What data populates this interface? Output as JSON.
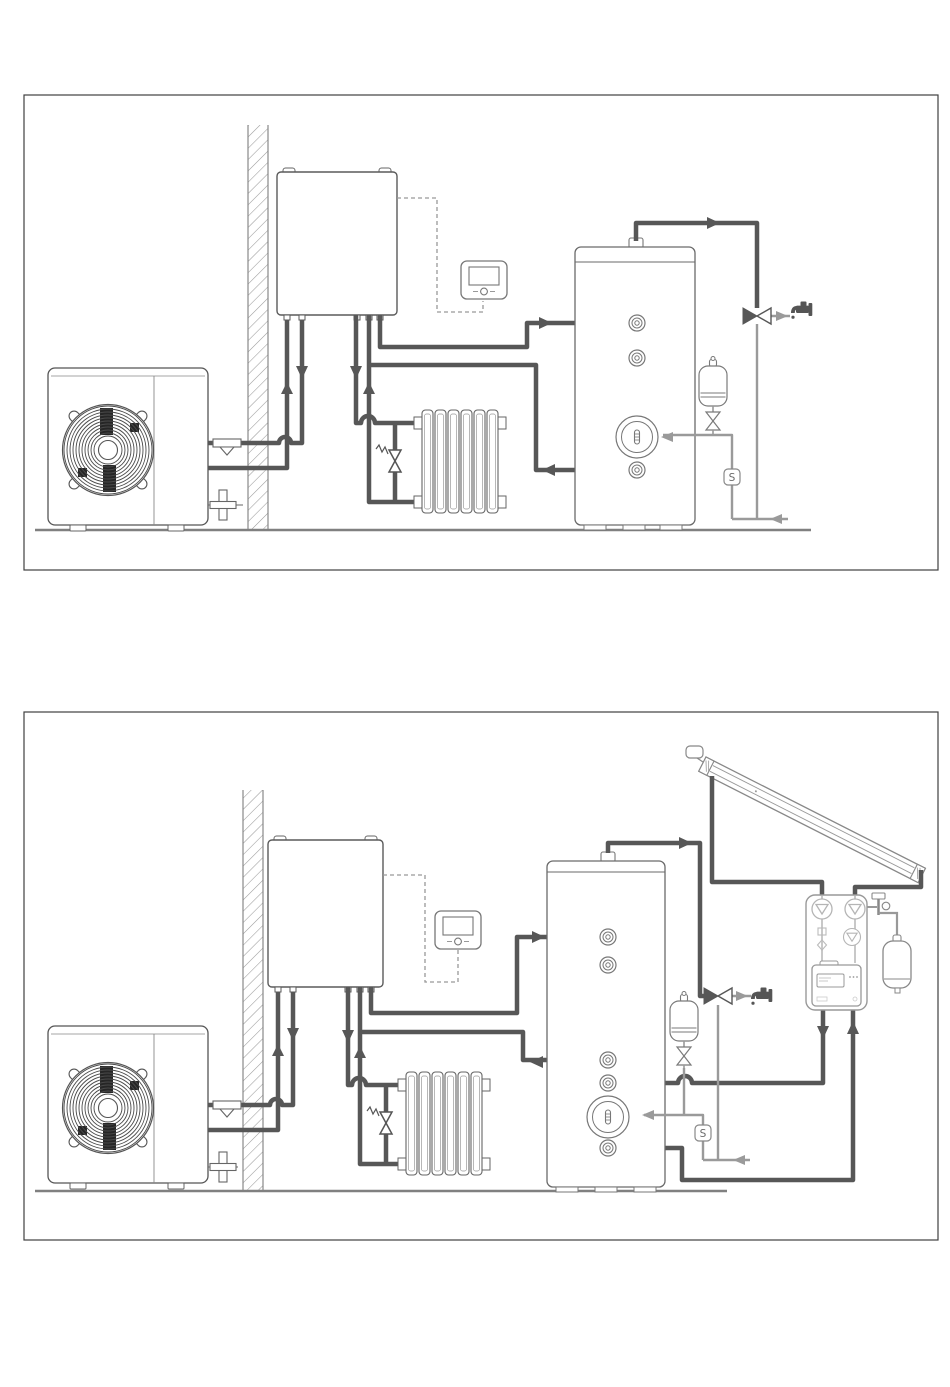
{
  "page": {
    "background": "#ffffff",
    "width": 950,
    "height": 1387
  },
  "colors": {
    "frame": "#3f3f3f",
    "line": "#666666",
    "pipe_dark": "#575757",
    "pipe_gray": "#9a9a9a",
    "station_accent": "#b5b5b5",
    "fan_dark": "#262626",
    "hatch": "#999999"
  },
  "icons": [
    {
      "name": "hot-water-tap-icon",
      "glyph": "faucet"
    },
    {
      "name": "sensor-badge",
      "glyph": "S"
    },
    {
      "name": "mixing-valve-icon",
      "glyph": "bowtie-horizontal"
    },
    {
      "name": "safety-valve-icon",
      "glyph": "bowtie-vertical"
    },
    {
      "name": "fan-icon",
      "glyph": "concentric-grille"
    }
  ],
  "diagrams": [
    {
      "id": "air-to-water-heat-pump-with-dhw-tank",
      "sensor_label": "S",
      "components": [
        "outdoor-heat-pump-unit",
        "exterior-wall",
        "indoor-hydrobox",
        "wired-remote-controller",
        "radiator-with-bypass-valve",
        "dhw-storage-tank",
        "tank-thermometer",
        "expansion-vessel-with-safety-valve",
        "thermostatic-mixing-valve",
        "hot-water-tap",
        "cold-water-inlet",
        "temperature-sensor"
      ]
    },
    {
      "id": "air-to-water-heat-pump-with-dhw-tank-and-solar",
      "sensor_label": "S",
      "components": [
        "outdoor-heat-pump-unit",
        "exterior-wall",
        "indoor-hydrobox",
        "wired-remote-controller",
        "radiator-with-bypass-valve",
        "solar-dhw-storage-tank",
        "tank-thermometer",
        "expansion-vessel-with-safety-valve",
        "thermostatic-mixing-valve",
        "hot-water-tap",
        "cold-water-inlet",
        "temperature-sensor",
        "solar-collector",
        "solar-pumping-station",
        "solar-expansion-vessel"
      ]
    }
  ]
}
